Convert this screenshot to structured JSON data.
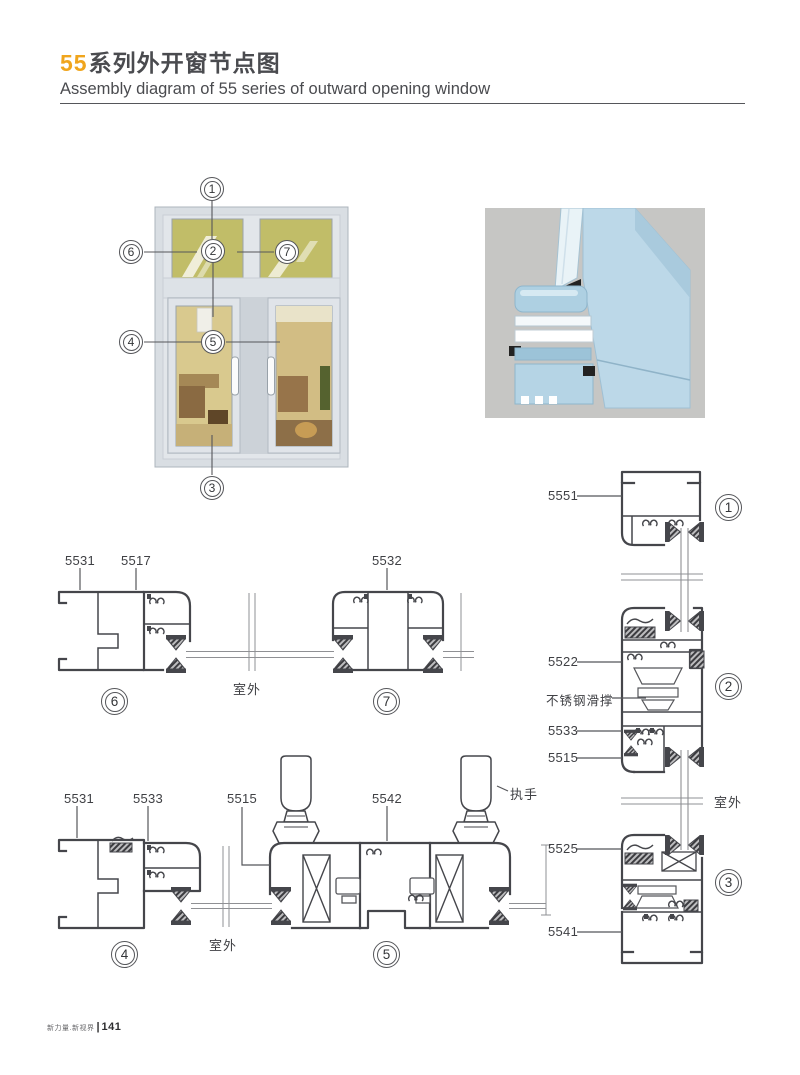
{
  "page": {
    "title_highlight": "55",
    "title_rest": "系列外开窗节点图",
    "subtitle": "Assembly diagram of 55 series of outward opening window",
    "footer_brand": "新力量.新视界",
    "footer_divider": "|",
    "footer_page": "141"
  },
  "overview": {
    "callouts": [
      {
        "id": "1"
      },
      {
        "id": "2"
      },
      {
        "id": "3"
      },
      {
        "id": "4"
      },
      {
        "id": "5"
      },
      {
        "id": "6"
      },
      {
        "id": "7"
      }
    ]
  },
  "details": {
    "d1": {
      "num": "1",
      "part_labels": [
        "5551"
      ]
    },
    "d2": {
      "num": "2",
      "part_labels": [
        "5522",
        "不锈钢滑撑",
        "5533",
        "5515"
      ]
    },
    "d3": {
      "num": "3",
      "part_labels": [
        "5525",
        "5541"
      ],
      "outdoor": "室外"
    },
    "d4": {
      "num": "4",
      "part_labels": [
        "5531",
        "5533"
      ],
      "outdoor": "室外"
    },
    "d5": {
      "num": "5",
      "part_labels": [
        "5515",
        "5542"
      ],
      "handle": "执手"
    },
    "d6": {
      "num": "6",
      "part_labels": [
        "5531",
        "5517"
      ],
      "outdoor": "室外"
    },
    "d7": {
      "num": "7",
      "part_labels": [
        "5532"
      ]
    }
  },
  "colors": {
    "accent_orange": "#F0A51D",
    "ink": "#4A4B4F",
    "drawing_line": "#45464B",
    "window_frame": "#D9DEE3",
    "transom_glass": "#C1BD68",
    "render_bg": "#C6C6C4",
    "profile_blue": "#B7D3E4"
  }
}
